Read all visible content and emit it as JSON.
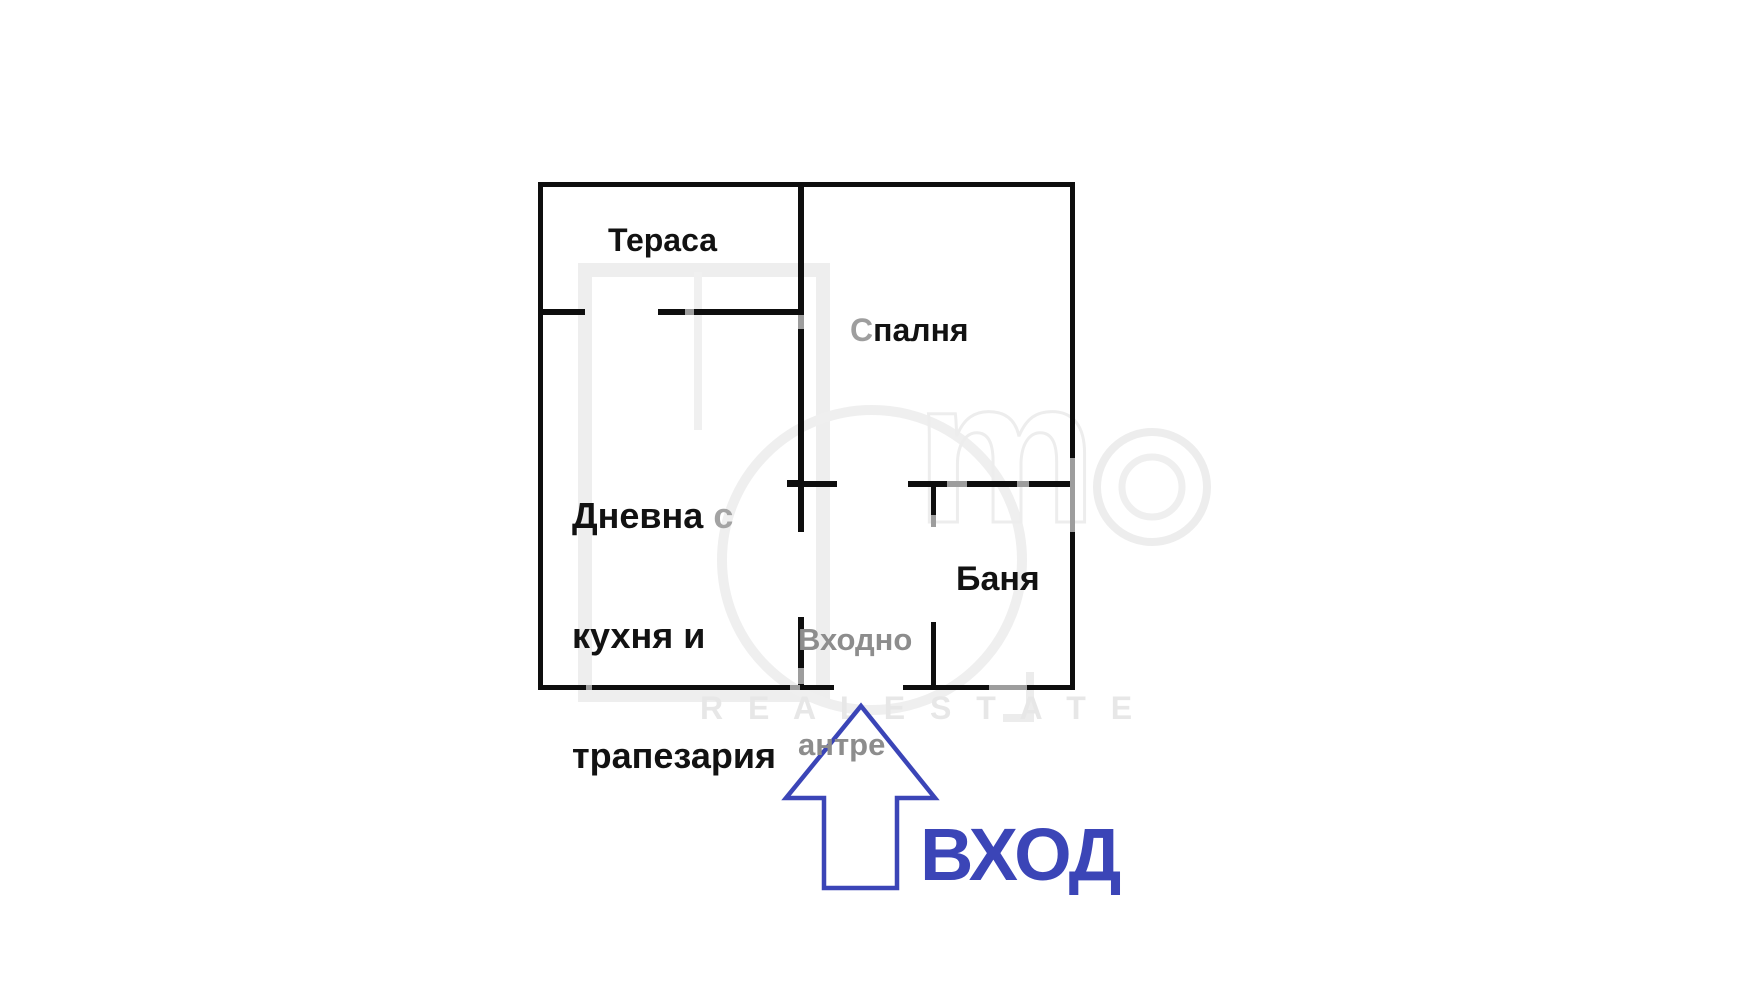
{
  "floor_plan": {
    "rooms": {
      "terrace": {
        "label": "Тераса"
      },
      "bedroom": {
        "label_first": "С",
        "label_rest": "палня"
      },
      "living": {
        "line1_word": "Дневна ",
        "line1_suffix": "с",
        "line2": "кухня и",
        "line3": "трапезария"
      },
      "hall": {
        "line1": "Входно",
        "line2": "антре"
      },
      "bath": {
        "label": "Баня"
      }
    },
    "entrance": {
      "label": "ВХОД"
    },
    "watermark": {
      "logo_m": "m",
      "tagline": "R E A L   E S T A T E"
    },
    "colors": {
      "wall": "#0e0e0e",
      "entrance_blue": "#3b45b7",
      "hall_text_gray": "#8d8d8d",
      "watermark_gray": "#ececec"
    }
  }
}
